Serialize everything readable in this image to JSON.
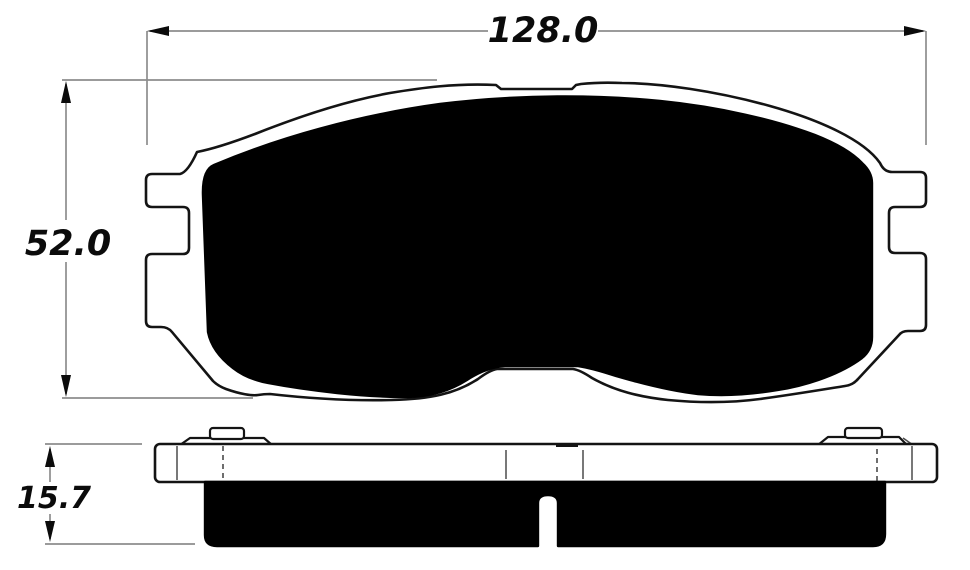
{
  "dimensions": {
    "width": {
      "value": "128.0"
    },
    "height": {
      "value": "52.0"
    },
    "thickness": {
      "value": "15.7"
    }
  },
  "colors": {
    "outline": "#141414",
    "fill": "#000000",
    "extension_line": "#8d8d8d",
    "label_text": "#0b0b0b",
    "background": "#ffffff"
  }
}
